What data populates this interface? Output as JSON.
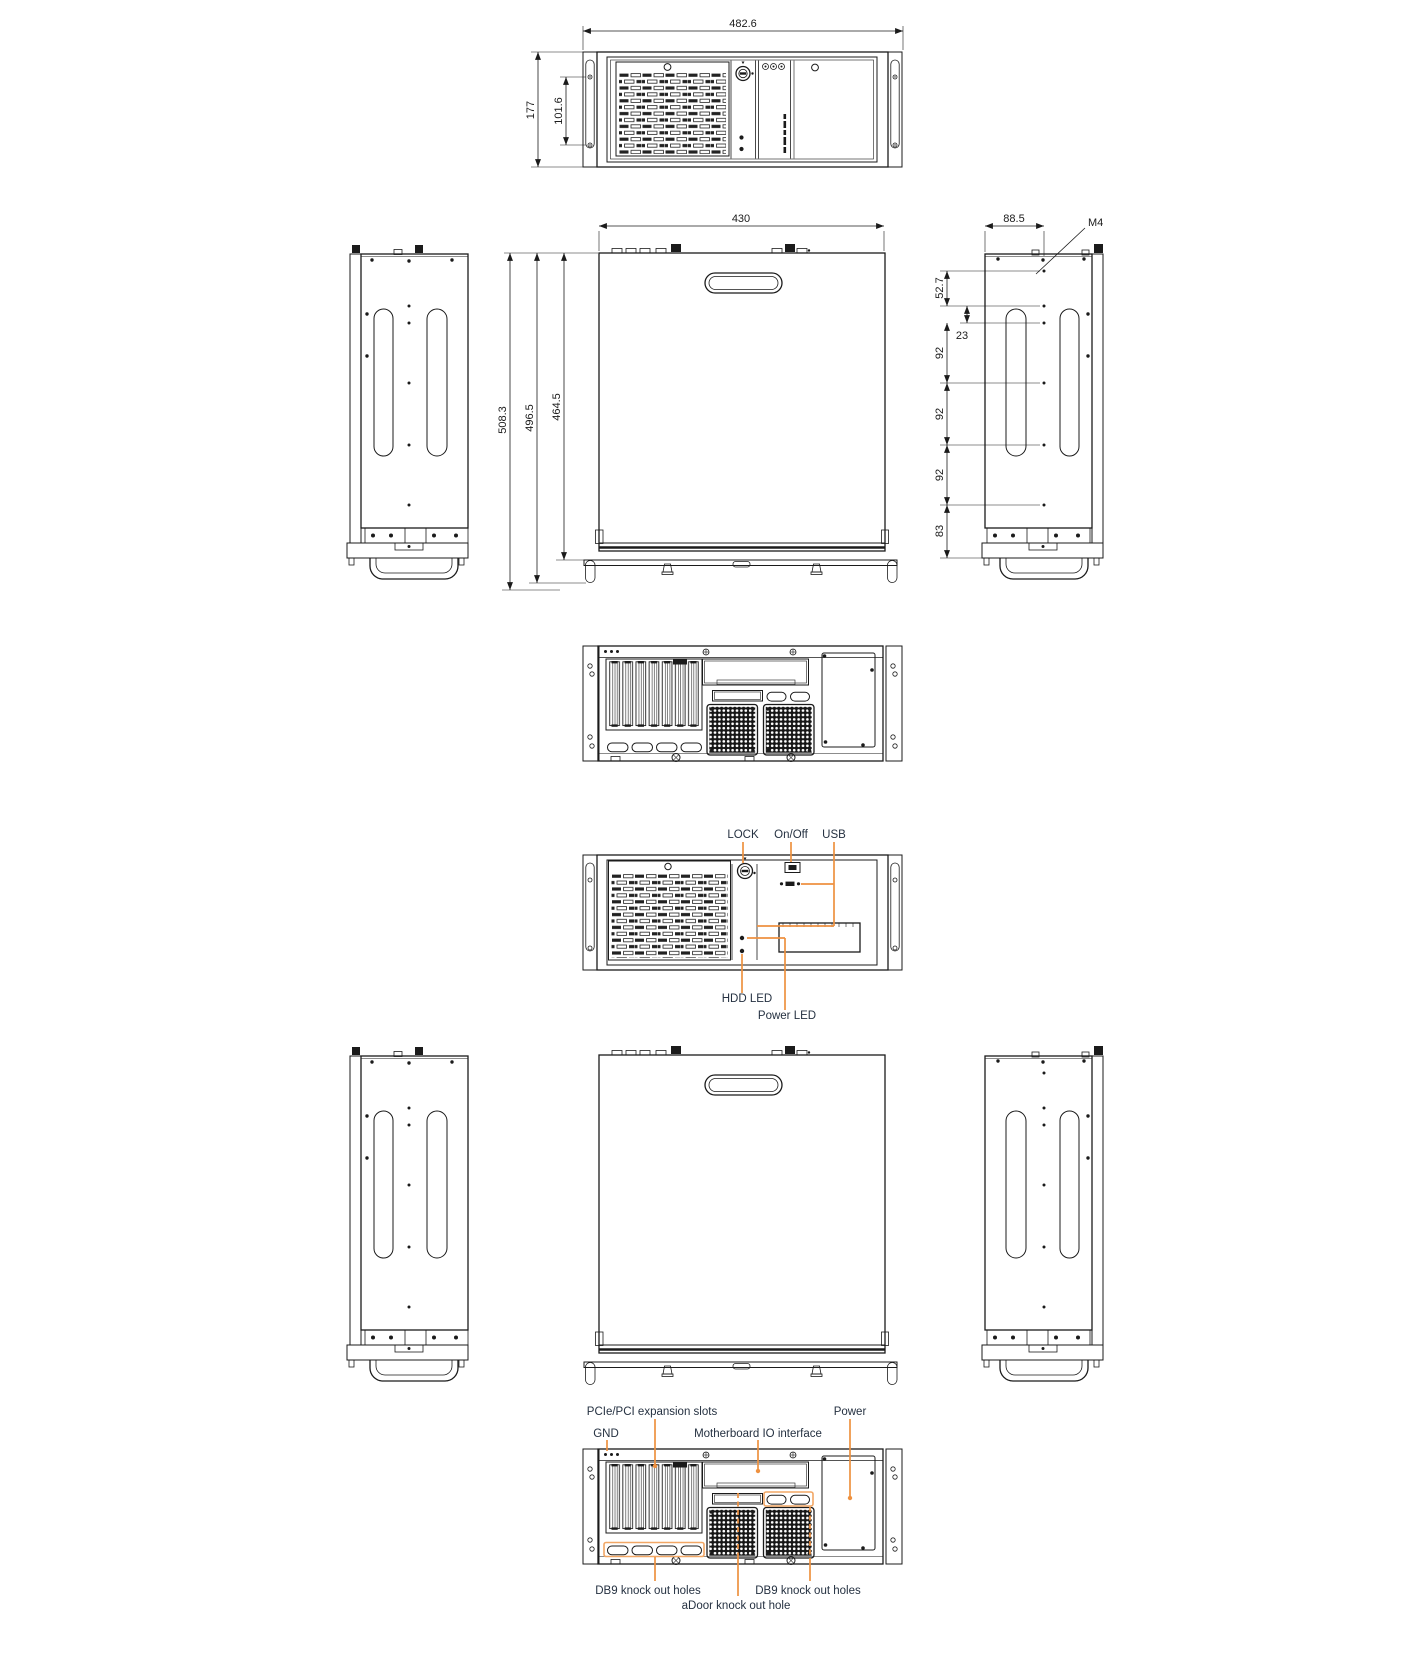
{
  "document": {
    "type": "technical-drawing",
    "subject": "4U rackmount industrial chassis - dimensioned views and panel callouts",
    "background": "#ffffff"
  },
  "colors": {
    "line": "#1b1b1b",
    "dimension_text": "#1b1b1b",
    "callout_text": "#253141",
    "accent_orange": "#ee9140"
  },
  "dims": {
    "front_width": "482.6",
    "front_height": "177",
    "front_handle_span": "101.6",
    "top_width": "430",
    "depth_overall": "508.3",
    "depth_mid": "496.5",
    "depth_body": "464.5",
    "side_hole_offset_x": "88.5",
    "thread": "M4",
    "side_top_offset": "52.7",
    "side_hole_gap": "23",
    "side_pitches": [
      "92",
      "92",
      "92"
    ],
    "side_bottom_offset": "83"
  },
  "callouts": {
    "front": {
      "lock": "LOCK",
      "on_off": "On/Off",
      "usb": "USB",
      "hdd_led": "HDD LED",
      "power_led": "Power LED"
    },
    "rear": {
      "expansion": "PCIe/PCI expansion slots",
      "gnd": "GND",
      "mb_io": "Motherboard IO interface",
      "power": "Power",
      "db9_left": "DB9 knock out holes",
      "db9_right": "DB9 knock out holes",
      "adoor": "aDoor knock out hole"
    }
  }
}
